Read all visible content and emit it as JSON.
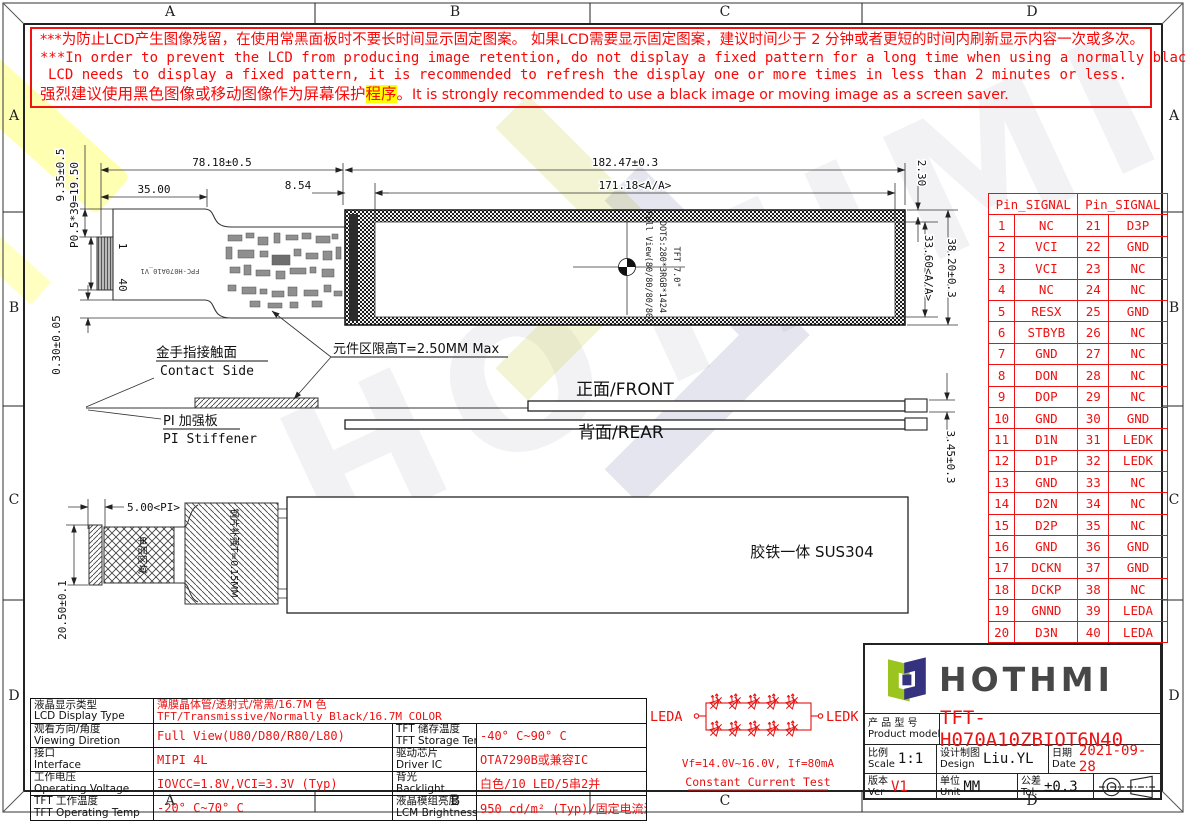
{
  "warning": {
    "line1": "***为防止LCD产生图像残留，在使用常黑面板时不要长时间显示固定图案。 如果LCD需要显示固定图案，建议时间少于 2 分钟或者更短的时间内刷新显示内容一次或多次。",
    "line2": "***In order to prevent the LCD from producing image retention, do not display a fixed pattern for a long time when using a normally black panel. If the",
    "line3": "LCD needs to display a fixed pattern, it is recommended to refresh the display one or more times in less than 2 minutes or less.",
    "line4_zh": "强烈建议使用黑色图像或移动图像作为屏幕保护",
    "line4_hl": "程序",
    "line4_punct": "。",
    "line4_en": "It is strongly recommended to use a black image or moving image as a screen saver."
  },
  "frame": {
    "cols": [
      "A",
      "B",
      "C",
      "D"
    ],
    "rows": [
      "A",
      "B",
      "C",
      "D"
    ]
  },
  "drawing": {
    "dims": {
      "d78": "78.18±0.5",
      "d35": "35.00",
      "d854": "8.54",
      "d182": "182.47±0.3",
      "d171": "171.18<A/A>",
      "d935": "9.35±0.5",
      "dp05": "P0.5*39=19.50",
      "d030": "0.30±0.05",
      "d230": "2.30",
      "d3820": "38.20±0.3",
      "d3360": "33.60<A/A>",
      "d345": "3.45±0.3",
      "d500": "5.00<PI>",
      "d2050": "20.50±0.1"
    },
    "labels": {
      "pin1": "1",
      "pin40": "40",
      "fpc": "FPC-H070A10_V1",
      "tft": "TFT 7.0\"",
      "dots": "DOTS:280*3RGB*1424",
      "fullview": "Full View(80/80/80/80)",
      "contact_zh": "金手指接触面",
      "contact_en": "Contact Side",
      "height_limit": "元件区限高T=2.50MM Max",
      "front": "正面/FRONT",
      "rear": "背面/REAR",
      "pi_zh": "PI 加强板",
      "pi_en": "PI Stiffener",
      "single_layer": "单层区域",
      "steel": "钢片补强T=0.15MM",
      "sus": "胶铁一体 SUS304"
    }
  },
  "pin_table": {
    "headers": [
      "Pin_SIGNAL",
      "Pin_SIGNAL"
    ],
    "rows": [
      [
        "1",
        "NC",
        "21",
        "D3P"
      ],
      [
        "2",
        "VCI",
        "22",
        "GND"
      ],
      [
        "3",
        "VCI",
        "23",
        "NC"
      ],
      [
        "4",
        "NC",
        "24",
        "NC"
      ],
      [
        "5",
        "RESX",
        "25",
        "GND"
      ],
      [
        "6",
        "STBYB",
        "26",
        "NC"
      ],
      [
        "7",
        "GND",
        "27",
        "NC"
      ],
      [
        "8",
        "DON",
        "28",
        "NC"
      ],
      [
        "9",
        "DOP",
        "29",
        "NC"
      ],
      [
        "10",
        "GND",
        "30",
        "GND"
      ],
      [
        "11",
        "D1N",
        "31",
        "LEDK"
      ],
      [
        "12",
        "D1P",
        "32",
        "LEDK"
      ],
      [
        "13",
        "GND",
        "33",
        "NC"
      ],
      [
        "14",
        "D2N",
        "34",
        "NC"
      ],
      [
        "15",
        "D2P",
        "35",
        "NC"
      ],
      [
        "16",
        "GND",
        "36",
        "GND"
      ],
      [
        "17",
        "DCKN",
        "37",
        "GND"
      ],
      [
        "18",
        "DCKP",
        "38",
        "NC"
      ],
      [
        "19",
        "GNND",
        "39",
        "LEDA"
      ],
      [
        "20",
        "D3N",
        "40",
        "LEDA"
      ]
    ]
  },
  "led_circuit": {
    "left": "LEDA",
    "right": "LEDK",
    "vf": "Vf=14.0V~16.0V, If=80mA",
    "test": "Constant Current Test"
  },
  "spec_table": {
    "row1": {
      "zh": "液晶显示类型",
      "en": "LCD Display Type",
      "v1": "薄膜晶体管/透射式/常黑/16.7M 色",
      "v2": "TFT/Transmissive/Normally Black/16.7M COLOR"
    },
    "rows": [
      {
        "zh1": "观看方向/角度",
        "en1": "Viewing Diretion",
        "val1": "Full View(U80/D80/R80/L80)",
        "zh2": "TFT 储存温度",
        "en2": "TFT Storage Temp",
        "val2": "-40° C~90° C"
      },
      {
        "zh1": "接口",
        "en1": "Interface",
        "val1": "MIPI 4L",
        "zh2": "驱动芯片",
        "en2": "Driver IC",
        "val2": "OTA7290B或兼容IC"
      },
      {
        "zh1": "工作电压",
        "en1": "Operating Voltage",
        "val1": "IOVCC=1.8V,VCI=3.3V (Typ)",
        "zh2": "背光",
        "en2": "Backlight",
        "val2": "白色/10 LED/5串2并"
      },
      {
        "zh1": "TFT 工作温度",
        "en1": "TFT Operating Temp",
        "val1": "-20° C~70° C",
        "zh2": "液晶模组亮度",
        "en2": "LCM Brightness",
        "val2": "950 cd/m² (Typ)/固定电流测试"
      }
    ]
  },
  "title_block": {
    "brand": "HOTHMI",
    "model_zh": "产 品 型 号",
    "model_en": "Product model",
    "model": "TFT-H070A10ZBIOT6N40",
    "scale_zh": "比例",
    "scale_en": "Scale",
    "scale": "1:1",
    "design_zh": "设计制图",
    "design_en": "Design",
    "design": "Liu.YL",
    "date_zh": "日期",
    "date_en": "Date",
    "date": "2021-09-28",
    "ver_zh": "版本",
    "ver_en": "Ver",
    "ver": "V1",
    "unit_zh": "单位",
    "unit_en": "Unit",
    "unit": "MM",
    "tol_zh": "公差",
    "tol_en": "Tol.",
    "tol": "±0.3"
  }
}
